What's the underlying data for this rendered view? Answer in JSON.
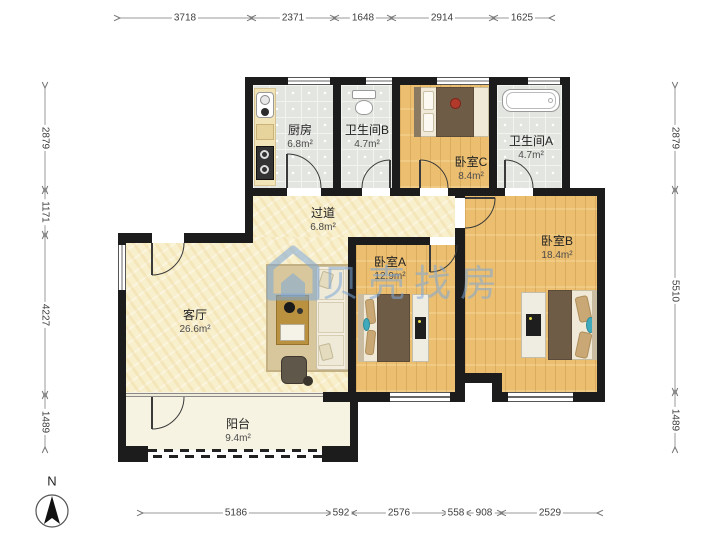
{
  "watermark": {
    "text": "贝壳找房",
    "icon": "house-logo",
    "color": "#7EA8D9"
  },
  "compass": {
    "label": "N"
  },
  "rooms": [
    {
      "id": "kitchen",
      "name": "厨房",
      "area": "6.8m²"
    },
    {
      "id": "bathroom-b",
      "name": "卫生间B",
      "area": "4.7m²"
    },
    {
      "id": "bedroom-c",
      "name": "卧室C",
      "area": "8.4m²"
    },
    {
      "id": "bathroom-a",
      "name": "卫生间A",
      "area": "4.7m²"
    },
    {
      "id": "hallway",
      "name": "过道",
      "area": "6.8m²"
    },
    {
      "id": "bedroom-a",
      "name": "卧室A",
      "area": "12.9m²"
    },
    {
      "id": "bedroom-b",
      "name": "卧室B",
      "area": "18.4m²"
    },
    {
      "id": "living-room",
      "name": "客厅",
      "area": "26.6m²"
    },
    {
      "id": "balcony",
      "name": "阳台",
      "area": "9.4m²"
    }
  ],
  "dimensions": {
    "top": [
      "3718",
      "2371",
      "1648",
      "2914",
      "1625"
    ],
    "left": [
      "2879",
      "1171",
      "4227",
      "1489"
    ],
    "right": [
      "2879",
      "5510",
      "1489"
    ],
    "bottom": [
      "5186",
      "592",
      "2576",
      "558",
      "908",
      "2529"
    ]
  },
  "colors": {
    "wall": "#1C1C1C",
    "wood_floor": "#ECBF70",
    "tile_floor": "#E3E5E0",
    "living_floor": "#F8EFCC",
    "balcony_floor": "#F6F3E2",
    "watermark_blue": "#7EA8D9",
    "blanket_brown": "#6F5C46",
    "accent_teal": "#3FAABB"
  }
}
